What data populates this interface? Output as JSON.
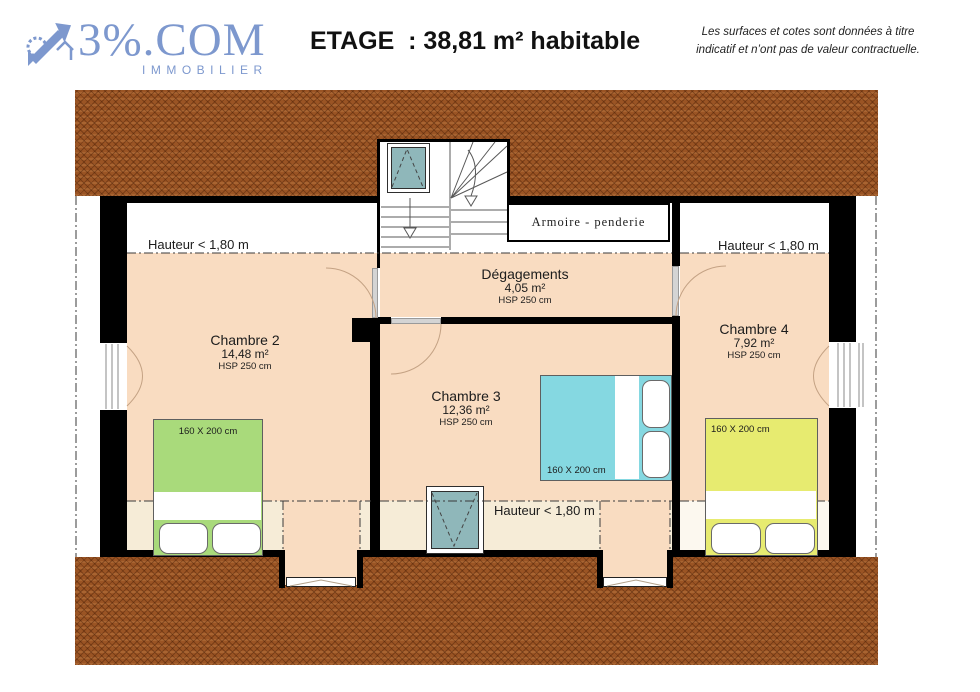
{
  "header": {
    "brand": "3%.COM",
    "brand_sub": "IMMOBILIER",
    "title": "ETAGE  : 38,81 m² habitable",
    "disclaimer1": "Les surfaces et cotes sont données à titre",
    "disclaimer2": "indicatif et n’ont pas de valeur contractuelle."
  },
  "plan": {
    "closet_label": "Armoire - penderie",
    "height_note_left": "Hauteur < 1,80 m",
    "height_note_right": "Hauteur < 1,80 m",
    "height_note_bottom": "Hauteur < 1,80 m",
    "rooms": {
      "chambre2": {
        "name": "Chambre 2",
        "area": "14,48 m²",
        "hsp": "HSP 250 cm",
        "bed_size": "160 X 200 cm"
      },
      "chambre3": {
        "name": "Chambre 3",
        "area": "12,36 m²",
        "hsp": "HSP 250 cm",
        "bed_size": "160 X 200 cm"
      },
      "chambre4": {
        "name": "Chambre 4",
        "area": "7,92 m²",
        "hsp": "HSP 250 cm",
        "bed_size": "160 X 200 cm"
      },
      "degagements": {
        "name": "Dégagements",
        "area": "4,05 m²",
        "hsp": "HSP 250 cm"
      }
    },
    "colors": {
      "roof": "#9a5424",
      "room": "#f9dcc1",
      "low_ceiling": "#f6ecd7",
      "velux": "#8fb7ba",
      "bed_green": "#a9da7b",
      "bed_cyan": "#85d8e1",
      "bed_yellow": "#e7eb70",
      "logo_blue": "#7d98ce"
    }
  }
}
